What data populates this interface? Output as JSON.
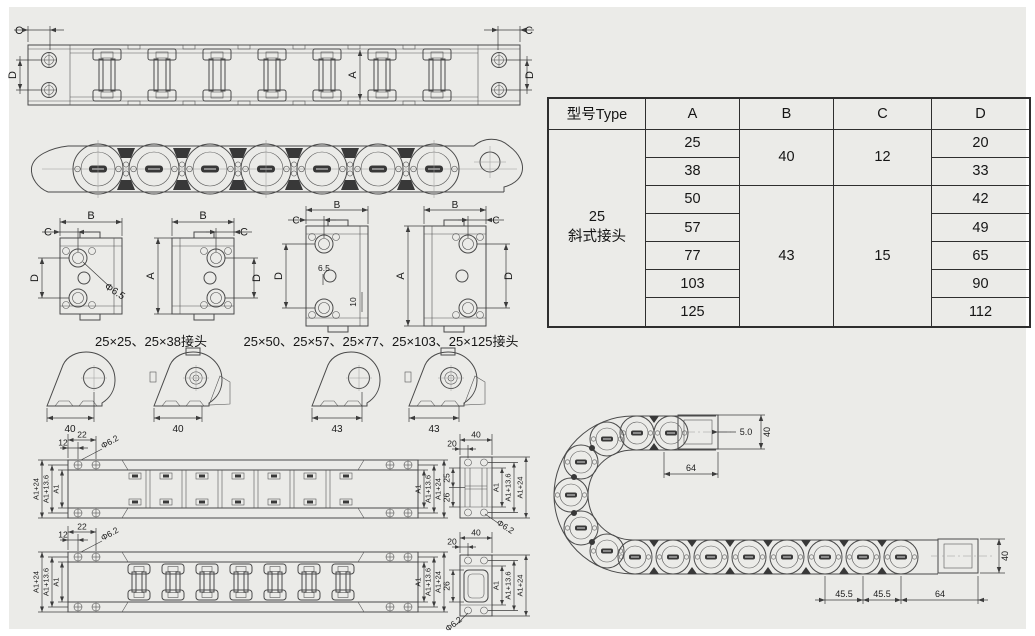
{
  "colors": {
    "page_bg": "#ffffff",
    "panel_bg": "#ebebe8",
    "drawing_line": "#4a4a4a",
    "dark_fill": "#383838",
    "table_border": "#2e2e2e",
    "text": "#1b1b1b"
  },
  "table": {
    "headers": {
      "type": "型号Type",
      "a": "A",
      "b": "B",
      "c": "C",
      "d": "D"
    },
    "type_label": "25\n斜式接头",
    "rows": [
      {
        "a": "25",
        "d": "20"
      },
      {
        "a": "38",
        "d": "33"
      },
      {
        "a": "50",
        "d": "42"
      },
      {
        "a": "57",
        "d": "49"
      },
      {
        "a": "77",
        "d": "65"
      },
      {
        "a": "103",
        "d": "90"
      },
      {
        "a": "125",
        "d": "112"
      }
    ],
    "b_group1": "40",
    "b_group2": "43",
    "c_group1": "12",
    "c_group2": "15"
  },
  "captions": {
    "joint_small": "25×25、25×38接头",
    "joint_large": "25×50、25×57、25×77、25×103、25×125接头"
  },
  "dims": {
    "top_view": {
      "c_left": "C",
      "c_right": "C",
      "d_left": "D",
      "d_right": "D",
      "a": "A"
    },
    "joint1": {
      "b": "B",
      "c": "C",
      "d": "D",
      "dia": "Φ6.5"
    },
    "joint2": {
      "b": "B",
      "c": "C",
      "a": "A",
      "d": "D"
    },
    "joint3": {
      "b": "B",
      "c": "C",
      "d": "D",
      "hole": "6.5",
      "pitch": "10"
    },
    "joint4": {
      "b": "B",
      "c": "C",
      "a": "A",
      "d": "D"
    },
    "brackets": {
      "b1": "40",
      "b2": "40",
      "b3": "43",
      "b4": "43"
    },
    "chain1": {
      "w22": "22",
      "w12": "12",
      "dia": "Φ6.2",
      "left_outer": "A1+24",
      "left_mid": "A1+13.6",
      "left_inner": "A1",
      "right_inner": "A1",
      "right_mid": "A1+13.6",
      "right_outer": "A1+24"
    },
    "chain2": {
      "w22": "22",
      "w12": "12",
      "dia": "Φ6.2",
      "left_outer": "A1+24",
      "left_mid": "A1+13.6",
      "left_inner": "A1",
      "right_inner": "A1",
      "right_mid": "A1+13.6",
      "right_outer": "A1+24"
    },
    "end1": {
      "w40": "40",
      "w20": "20",
      "h25": "25",
      "h26": "26",
      "inner": "A1",
      "mid": "A1+13.6",
      "outer": "A1+24",
      "dia": "Φ6.2"
    },
    "end2": {
      "w40": "40",
      "w20": "20",
      "h26": "26",
      "inner": "A1",
      "mid": "A1+13.6",
      "outer": "A1+24",
      "dia": "Φ6.2"
    },
    "bend": {
      "gap": "5.0",
      "top_h": "40",
      "top_len": "64",
      "pitch1": "45.5",
      "pitch2": "45.5",
      "end_len": "64",
      "bot_h": "40"
    }
  }
}
